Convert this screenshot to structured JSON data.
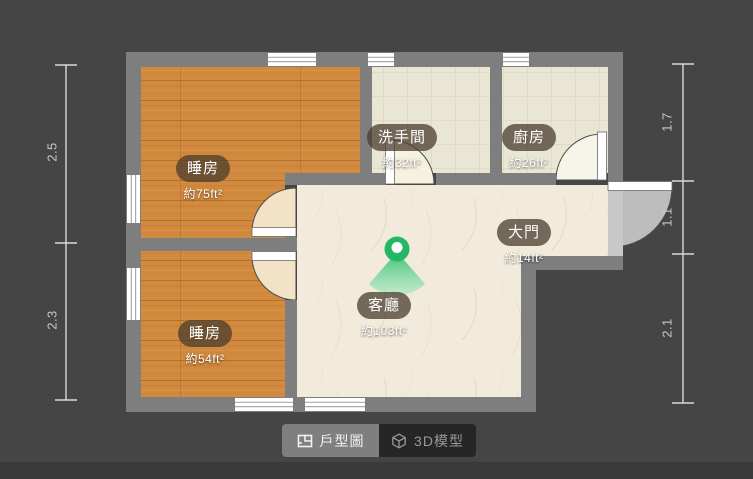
{
  "app": {
    "view_title": "floor-plan-viewer"
  },
  "rooms": [
    {
      "id": "bedroom-1",
      "name": "睡房",
      "area": "約75ft²"
    },
    {
      "id": "bedroom-2",
      "name": "睡房",
      "area": "約54ft²"
    },
    {
      "id": "bathroom",
      "name": "洗手間",
      "area": "約32ft²"
    },
    {
      "id": "kitchen",
      "name": "廚房",
      "area": "約26ft²"
    },
    {
      "id": "entrance",
      "name": "大門",
      "area": "約14ft²"
    },
    {
      "id": "living-room",
      "name": "客廳",
      "area": "約103ft²"
    }
  ],
  "dimensions": {
    "left": [
      {
        "value": "2.5"
      },
      {
        "value": "2.3"
      }
    ],
    "right": [
      {
        "value": "1.7"
      },
      {
        "value": "1.1"
      },
      {
        "value": "2.1"
      }
    ]
  },
  "tabs": [
    {
      "label": "戶型圖",
      "icon": "floorplan-icon",
      "active": true
    },
    {
      "label": "3D模型",
      "icon": "cube-3d-icon",
      "active": false
    }
  ],
  "colors": {
    "background": "#454545",
    "bottom_strip": "#3a3a3a",
    "wall": "#7e7e7e",
    "wood_floor": "#d18a3e",
    "tile_floor": "#e9e6d3",
    "marble_floor": "#f2ebdb",
    "marker_green": "#25b864",
    "tab_active_bg": "#7f7f7f",
    "tab_inactive_bg": "#262626",
    "dimension_line": "#d9d9d9"
  }
}
